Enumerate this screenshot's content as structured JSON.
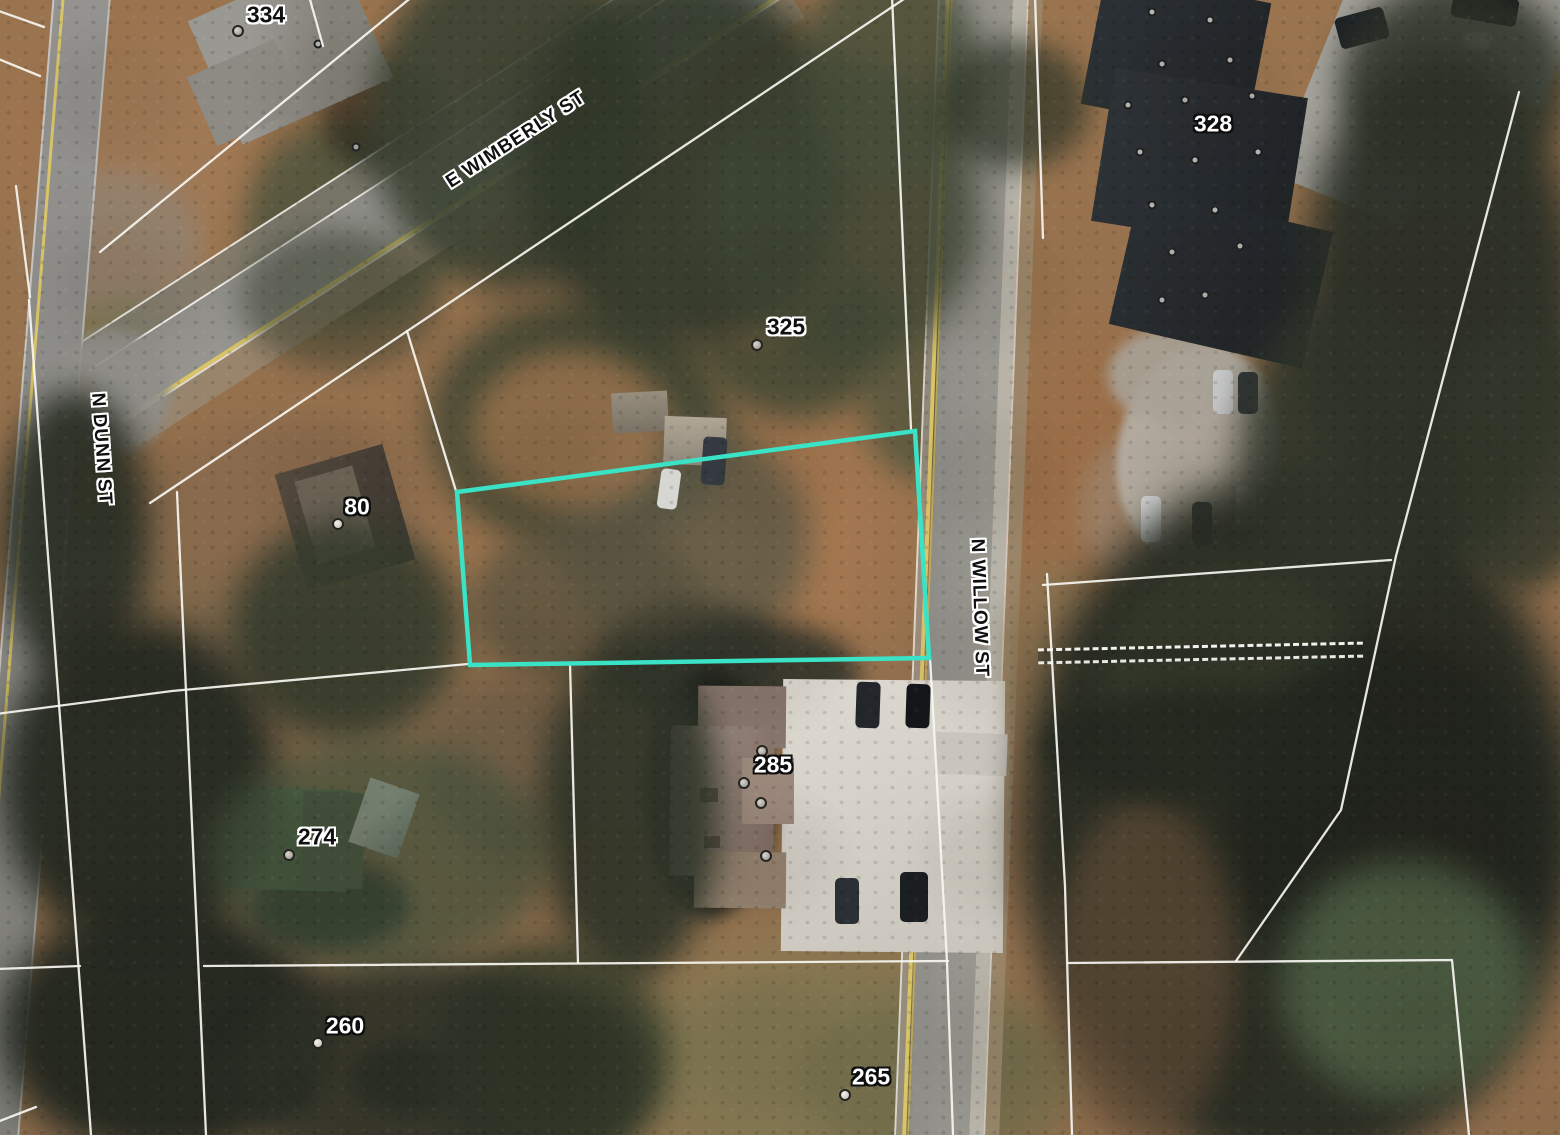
{
  "map": {
    "view": "aerial satellite imagery with parcel overlay",
    "colors": {
      "parcel-highlight": "#3ae2c6",
      "parcel-line": "#f7f6f1",
      "road-yellow": "#d9c468",
      "label-dark": "#101010",
      "label-dark-halo": "#ffffff",
      "label-light": "#ffffff",
      "label-light-halo": "#0e0e0e"
    },
    "street_labels": [
      {
        "id": "e-wimberly-st",
        "text": "E WIMBERLY ST"
      },
      {
        "id": "n-dunn-st",
        "text": "N DUNN ST"
      },
      {
        "id": "n-willow-st",
        "text": "N WILLOW ST"
      }
    ],
    "address_labels": [
      {
        "id": "334",
        "text": "334"
      },
      {
        "id": "328",
        "text": "328"
      },
      {
        "id": "325",
        "text": "325"
      },
      {
        "id": "80",
        "text": "80"
      },
      {
        "id": "285",
        "text": "285"
      },
      {
        "id": "274",
        "text": "274"
      },
      {
        "id": "260",
        "text": "260"
      },
      {
        "id": "265",
        "text": "265"
      }
    ],
    "highlighted_parcel": {
      "outline_color": "#3ae2c6",
      "location": "vacant lot between E Wimberly St and N Willow St"
    }
  }
}
